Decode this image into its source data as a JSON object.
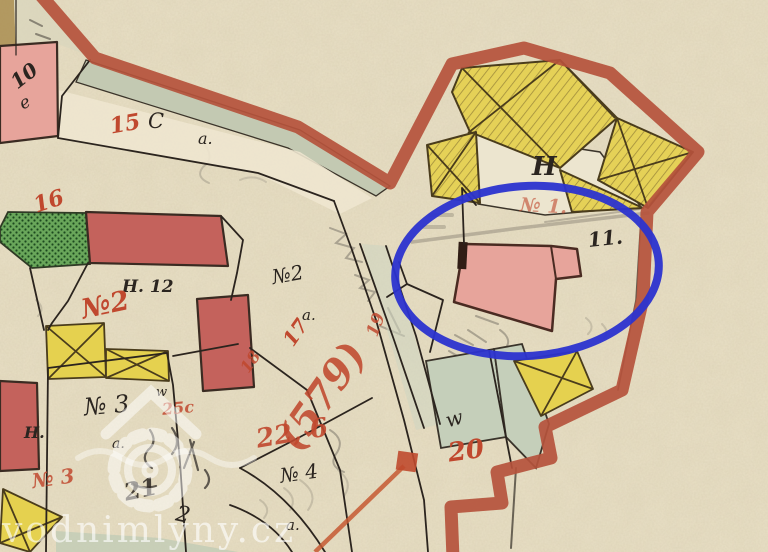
{
  "map": {
    "type": "historical-cadastral-map",
    "watermark": {
      "text": "vodnimlyny.cz"
    },
    "highlight": {
      "shape": "ellipse",
      "color": "#2b33cf"
    },
    "colors": {
      "paper": "#e9e0c6",
      "border_red": "#b5523c",
      "building_pink": "#e7a49b",
      "building_red": "#c4625c",
      "building_yellow": "#e5d14f",
      "garden_green": "#5f9e52",
      "meadow_green": "#c5cfba",
      "annotation_red": "#c65a33",
      "label_red": "#c0482e",
      "ink": "#2b2520"
    },
    "labels": {
      "p10": "10",
      "p10e": "e",
      "p15": "15",
      "c": "C",
      "a1": "a.",
      "p16": "16",
      "h12": "H. 12",
      "no2_red": "№2",
      "no2_black": "№2",
      "a2": "a.",
      "p17": "17",
      "p18": "18",
      "p579": "(579)",
      "p19": "19",
      "p226": "22, 6",
      "no4": "№ 4",
      "a3": "a.",
      "a4": "a.",
      "h_big": "H",
      "no1": "№ 1.",
      "p11": "11.",
      "w1": "w",
      "p20": "20",
      "w2": "w",
      "no3_black": "№ 3",
      "p25c": "25c",
      "h2": "H.",
      "no3_red": "№ 3",
      "p21": "21",
      "p2s": "2"
    }
  }
}
